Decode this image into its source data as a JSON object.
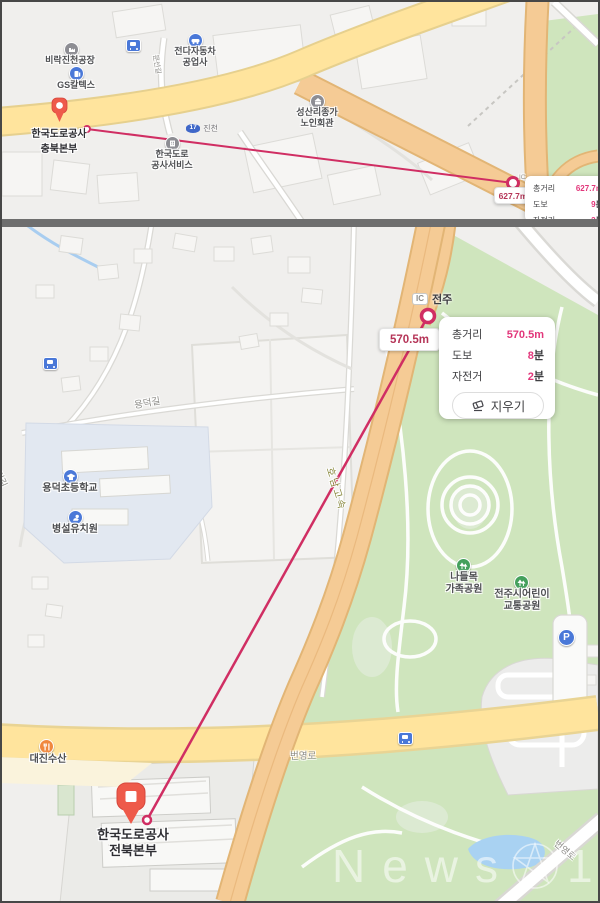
{
  "colors": {
    "measure_line": "#d02e63",
    "pin_red": "#ee5a4a",
    "value_pink": "#e2377b",
    "distance_red": "#b53457",
    "road_yellow": "#ffe49d",
    "highway_orange": "#f5cb95",
    "park_green": "#cfe5bd",
    "water_blue": "#a9d2f2"
  },
  "top_map": {
    "pois": {
      "birak": {
        "label": "비락진천공장"
      },
      "gs": {
        "label": "GS칼텍스"
      },
      "motors": {
        "label": "전다자동차\n공업사"
      },
      "seongsan": {
        "label": "성산리종가\n노인회관"
      },
      "service": {
        "label": "한국도로\n공사서비스"
      }
    },
    "roads": {
      "munseon": "문선길",
      "badge_num": "17",
      "badge_name": "진천"
    },
    "marker": {
      "label": "한국도로공사\n충북본부"
    },
    "endpoint_tag": "IC",
    "distance_box": "627.7m",
    "info": {
      "total_label": "총거리",
      "total_value": "627.7m",
      "walk_label": "도보",
      "walk_value": "9",
      "walk_unit": "분",
      "bike_label": "자전거",
      "bike_value": "2",
      "bike_unit": "분"
    }
  },
  "bottom_map": {
    "ic": {
      "badge": "IC",
      "name": "전주"
    },
    "distance_box": "570.5m",
    "popup": {
      "total_label": "총거리",
      "total_value": "570.5m",
      "walk_label": "도보",
      "walk_value": "8",
      "walk_unit": "분",
      "bike_label": "자전거",
      "bike_value": "2",
      "bike_unit": "분",
      "clear_label": "지우기"
    },
    "pois": {
      "elementary": {
        "label": "용덕초등학교"
      },
      "kindergarten": {
        "label": "병설유치원"
      },
      "family_park": {
        "label": "나들목\n가족공원"
      },
      "traffic_park": {
        "label": "전주시어린이\n교통공원"
      },
      "daejin": {
        "label": "대진수산"
      },
      "parking": {
        "label": "P"
      }
    },
    "roads": {
      "yongdeok": "용덕길",
      "yongdeok_edge": "용덕길",
      "honam": "호남고속",
      "byeongyeong": "번영로",
      "byeongyeong_corner": "번영로"
    },
    "marker": {
      "label": "한국도로공사\n전북본부"
    }
  },
  "watermark": {
    "text": "News",
    "one": "1"
  }
}
